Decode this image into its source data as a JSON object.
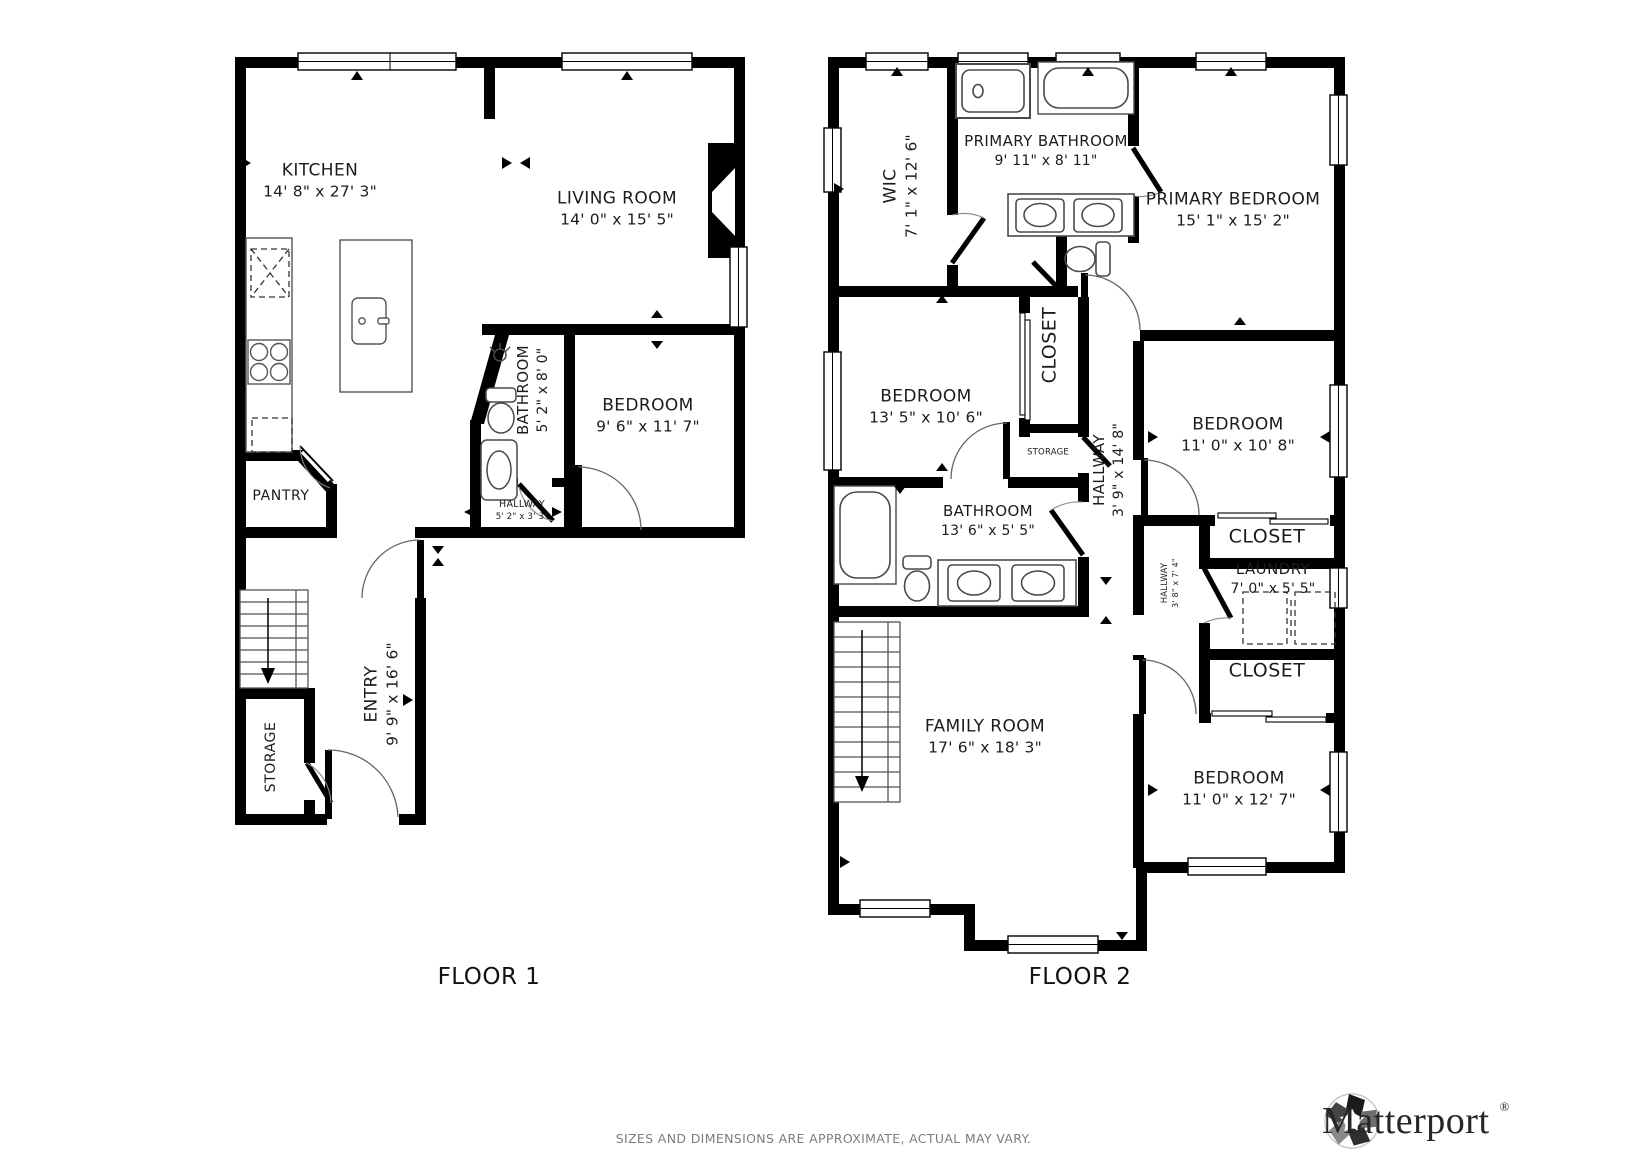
{
  "floor1": {
    "title": "FLOOR 1",
    "rooms": {
      "kitchen": {
        "name": "KITCHEN",
        "dims": "14' 8\" x 27' 3\""
      },
      "living_room": {
        "name": "LIVING ROOM",
        "dims": "14' 0\" x 15' 5\""
      },
      "bathroom": {
        "name": "BATHROOM",
        "dims": "5' 2\" x 8' 0\""
      },
      "bedroom": {
        "name": "BEDROOM",
        "dims": "9' 6\" x 11' 7\""
      },
      "hallway": {
        "name": "HALLWAY",
        "dims": "5' 2\" x 3' 3\""
      },
      "pantry": {
        "name": "PANTRY"
      },
      "entry": {
        "name": "ENTRY",
        "dims": "9' 9\" x 16' 6\""
      },
      "storage": {
        "name": "STORAGE"
      }
    }
  },
  "floor2": {
    "title": "FLOOR 2",
    "rooms": {
      "wic": {
        "name": "WIC",
        "dims": "7' 1\" x 12' 6\""
      },
      "primary_bathroom": {
        "name": "PRIMARY BATHROOM",
        "dims": "9' 11\" x 8' 11\""
      },
      "primary_bedroom": {
        "name": "PRIMARY BEDROOM",
        "dims": "15' 1\" x 15' 2\""
      },
      "bedroom_a": {
        "name": "BEDROOM",
        "dims": "13' 5\" x 10' 6\""
      },
      "closet_a": {
        "name": "CLOSET"
      },
      "storage": {
        "name": "STORAGE"
      },
      "hallway": {
        "name": "HALLWAY",
        "dims": "3' 9\" x 14' 8\""
      },
      "bedroom_b": {
        "name": "BEDROOM",
        "dims": "11' 0\" x 10' 8\""
      },
      "bathroom": {
        "name": "BATHROOM",
        "dims": "13' 6\" x 5' 5\""
      },
      "closet_b": {
        "name": "CLOSET"
      },
      "laundry": {
        "name": "LAUNDRY",
        "dims": "7' 0\" x 5' 5\""
      },
      "hallway_small": {
        "name": "HALLWAY",
        "dims": "3' 8\" x 7' 4\""
      },
      "closet_c": {
        "name": "CLOSET"
      },
      "family_room": {
        "name": "FAMILY ROOM",
        "dims": "17' 6\" x 18' 3\""
      },
      "bedroom_c": {
        "name": "BEDROOM",
        "dims": "11' 0\" x 12' 7\""
      }
    }
  },
  "footer": {
    "disclaimer": "SIZES AND DIMENSIONS ARE APPROXIMATE, ACTUAL MAY VARY.",
    "brand": "Matterport",
    "registered": "®"
  },
  "colors": {
    "walls": "#000000",
    "labels": "#1c1c1c",
    "disclaimer_text": "#7d7d7d",
    "fixtures": "#4a4a4a"
  }
}
